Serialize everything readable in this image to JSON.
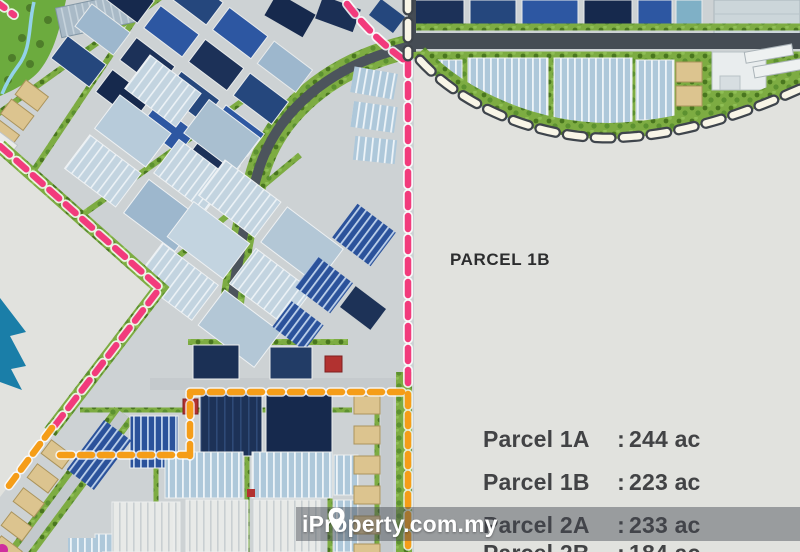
{
  "map": {
    "parcel_label": "PARCEL 1B",
    "legend": {
      "rows": [
        {
          "label": "Parcel 1A",
          "sep": ":",
          "value": "244 ac"
        },
        {
          "label": "Parcel 1B",
          "sep": ":",
          "value": "223 ac"
        },
        {
          "label": "Parcel 2A",
          "sep": ":",
          "value": "233 ac"
        },
        {
          "label": "Parcel 2B",
          "sep": ":",
          "value": "184 ac"
        }
      ]
    },
    "watermark": {
      "text": "iProperty.com.my",
      "icon": "location-pin-icon"
    },
    "colors": {
      "phase_boundary_pink": "#f23b7c",
      "parcel_boundary_white": "#f8f5e7",
      "plot_boundary_orange": "#f59d18",
      "parcel_empty": "#e1e2de",
      "label_text": "#2c2d2e",
      "legend_text": "#424345"
    }
  }
}
